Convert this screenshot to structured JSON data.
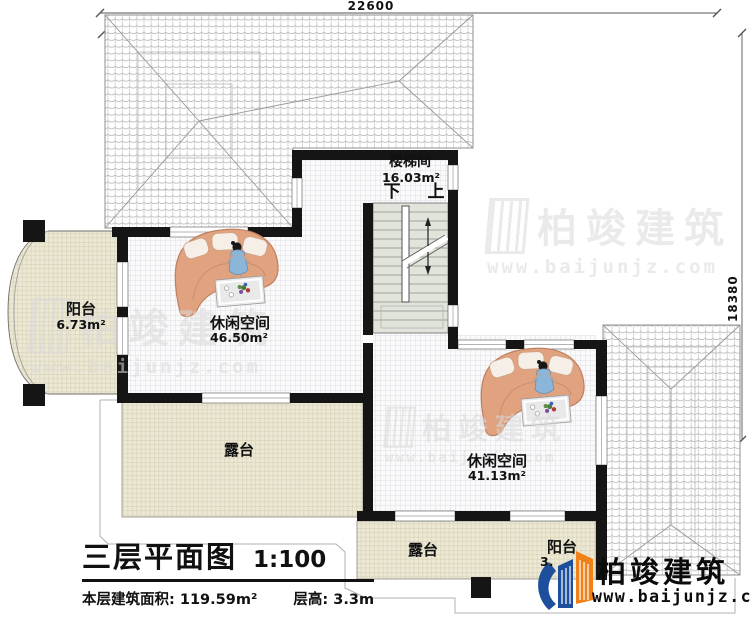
{
  "dimensions": {
    "top": "22600",
    "right": "18380"
  },
  "rooms": {
    "stairwell": {
      "name": "楼梯间",
      "area": "16.03m²",
      "down": "下",
      "up": "上"
    },
    "balcony_left": {
      "name": "阳台",
      "area": "6.73m²"
    },
    "leisure_a": {
      "name": "休闲空间",
      "area": "46.50m²"
    },
    "terrace_left": {
      "name": "露台"
    },
    "leisure_b": {
      "name": "休闲空间",
      "area": "41.13m²"
    },
    "terrace_bottom": {
      "name": "露台"
    },
    "balcony_bottom": {
      "name": "阳台",
      "area": "3."
    }
  },
  "title_block": {
    "title": "三层平面图",
    "scale": "1:100",
    "floor_area_label": "本层建筑面积:",
    "floor_area_value": "119.59m²",
    "floor_height_label": "层高:",
    "floor_height_value": "3.3m"
  },
  "branding": {
    "logo_text": "柏竣建筑",
    "logo_url": "www.baijunjz.com",
    "watermark_text": "柏竣建筑",
    "watermark_url": "www.baijunjz.com"
  },
  "colors": {
    "wall": "#151515",
    "beige_floor": "#ece8d4",
    "logo_blue": "#1e4f9c",
    "logo_orange": "#f08118"
  }
}
